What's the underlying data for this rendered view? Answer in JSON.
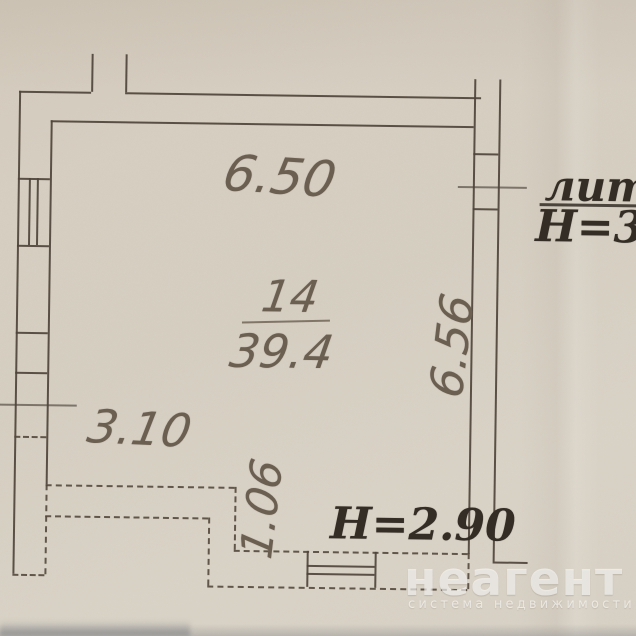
{
  "plan": {
    "room": {
      "number": "14",
      "area": "39.4"
    },
    "dimensions": {
      "top_width": "6.50",
      "right_height": "6.56",
      "bottom_left_width": "3.10",
      "step_depth": "1.06"
    },
    "labels": {
      "liter": "лит.А",
      "ceiling_height_main": "Н=3.2",
      "ceiling_height_lower": "Н=2.90"
    }
  },
  "watermark": {
    "logo": "неагент",
    "tagline": "система недвижимости",
    "color": "#ffffff"
  },
  "colors": {
    "paper": "#d6cfc2",
    "wall_line": "#4f443a",
    "pencil_text": "#6b5f51",
    "ink_text": "#332d26"
  }
}
